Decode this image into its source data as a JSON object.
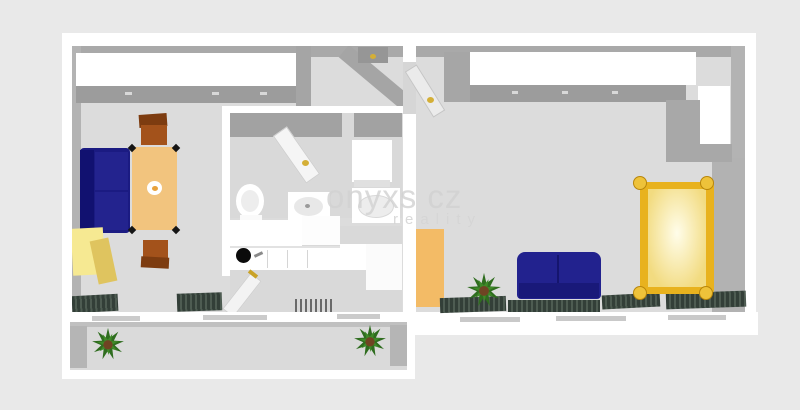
{
  "watermark": {
    "line1": "onyxs cz",
    "line2": "reality"
  },
  "palette": {
    "background": "#e9e9e9",
    "floor": "#dcdcdc",
    "wall_white": "#ffffff",
    "wall_gray": "#a9a9a9",
    "sofa_navy": "#1b1b82",
    "table_tan": "#f2c47e",
    "chair_brown": "#a3521b",
    "cabinet_yellow": "#f6e992",
    "bed_gold": "#e8b21e",
    "wardrobe_orange": "#f3bb66",
    "radiator_green": "#333f38",
    "plant_green": "#2f6d1f",
    "handle_gold": "#d4af37"
  },
  "scene": [
    {
      "name": "floor-left-unit",
      "x": 72,
      "y": 46,
      "w": 331,
      "h": 267,
      "color": "#dcdcdc"
    },
    {
      "name": "floor-bedroom",
      "x": 415,
      "y": 46,
      "w": 330,
      "h": 268,
      "color": "#dcdcdc"
    },
    {
      "name": "top-wall-inner-face",
      "x": 72,
      "y": 46,
      "w": 673,
      "h": 11,
      "color": "#a9a9a9"
    },
    {
      "name": "left-wall-inner-face",
      "x": 72,
      "y": 46,
      "w": 9,
      "h": 267,
      "color": "#b3b3b3"
    },
    {
      "name": "bedroom-right-wall-face-upper",
      "x": 731,
      "y": 46,
      "w": 14,
      "h": 114,
      "color": "#b3b3b3"
    },
    {
      "name": "bedroom-right-wall-face-lower",
      "x": 712,
      "y": 158,
      "w": 33,
      "h": 156,
      "color": "#b2b2b2"
    },
    {
      "name": "livingroom-wardrobe-top",
      "x": 76,
      "y": 53,
      "w": 220,
      "h": 33,
      "color": "#ffffff"
    },
    {
      "name": "livingroom-wardrobe-front",
      "x": 76,
      "y": 86,
      "w": 220,
      "h": 17,
      "color": "#9c9c9c"
    },
    {
      "name": "wardrobe-handle-1",
      "x": 125,
      "y": 92,
      "w": 7,
      "h": 3,
      "color": "#d8d8d8"
    },
    {
      "name": "wardrobe-handle-2",
      "x": 212,
      "y": 92,
      "w": 7,
      "h": 3,
      "color": "#d8d8d8"
    },
    {
      "name": "wardrobe-handle-3",
      "x": 260,
      "y": 92,
      "w": 7,
      "h": 3,
      "color": "#d8d8d8"
    },
    {
      "name": "hall-wall-stub",
      "x": 296,
      "y": 46,
      "w": 15,
      "h": 62,
      "color": "#a5a5a5"
    },
    {
      "name": "hall-diagonal-wall",
      "x": 334,
      "y": 70,
      "w": 84,
      "h": 16,
      "color": "#a5a5a5",
      "rotate": 40
    },
    {
      "name": "hall-entry-door",
      "x": 358,
      "y": 47,
      "w": 30,
      "h": 16,
      "color": "#969696"
    },
    {
      "name": "hall-entry-door-handle",
      "x": 370,
      "y": 54,
      "w": 6,
      "h": 5,
      "color": "#d4af37",
      "radius": "50%"
    },
    {
      "name": "bathroom-wall-left",
      "x": 222,
      "y": 106,
      "w": 8,
      "h": 170,
      "color": "#ffffff"
    },
    {
      "name": "bathroom-wall-top",
      "x": 222,
      "y": 106,
      "w": 186,
      "h": 7,
      "color": "#ffffff"
    },
    {
      "name": "bathroom-floor",
      "x": 230,
      "y": 113,
      "w": 172,
      "h": 105,
      "color": "#d9d9d9"
    },
    {
      "name": "bathroom-top-inner-face-a",
      "x": 230,
      "y": 113,
      "w": 112,
      "h": 24,
      "color": "#a2a2a2"
    },
    {
      "name": "bathroom-top-inner-face-b",
      "x": 354,
      "y": 113,
      "w": 48,
      "h": 24,
      "color": "#a2a2a2"
    },
    {
      "name": "bathroom-door-leaf",
      "x": 288,
      "y": 126,
      "w": 17,
      "h": 58,
      "color": "#f5f5f5",
      "rotate": -35,
      "border": "1px solid #cfcfcf"
    },
    {
      "name": "bathroom-door-handle",
      "x": 302,
      "y": 160,
      "w": 7,
      "h": 6,
      "color": "#d4af37",
      "radius": "50%"
    },
    {
      "name": "washing-machine",
      "x": 352,
      "y": 140,
      "w": 40,
      "h": 42,
      "color": "#ffffff"
    },
    {
      "name": "washing-machine-front",
      "x": 354,
      "y": 180,
      "w": 36,
      "h": 7,
      "color": "#e0e0e0"
    },
    {
      "name": "toilet-bowl",
      "kind": "ellipse",
      "x": 236,
      "y": 184,
      "w": 28,
      "h": 34,
      "color": "#ffffff"
    },
    {
      "name": "toilet-seat",
      "kind": "ellipse",
      "x": 241,
      "y": 190,
      "w": 18,
      "h": 22,
      "color": "#ededed"
    },
    {
      "name": "toilet-base",
      "x": 240,
      "y": 215,
      "w": 22,
      "h": 8,
      "color": "#fafafa"
    },
    {
      "name": "sink-cabinet",
      "x": 288,
      "y": 192,
      "w": 42,
      "h": 30,
      "color": "#ffffff"
    },
    {
      "name": "sink-bowl",
      "kind": "ellipse",
      "x": 294,
      "y": 197,
      "w": 29,
      "h": 19,
      "color": "#e8e8e8"
    },
    {
      "name": "sink-drain",
      "kind": "ellipse",
      "x": 305,
      "y": 204,
      "w": 5,
      "h": 4,
      "color": "#9a9a9a"
    },
    {
      "name": "shower-tray",
      "x": 352,
      "y": 188,
      "w": 48,
      "h": 35,
      "color": "#ffffff"
    },
    {
      "name": "shower-basin",
      "kind": "ellipse",
      "x": 358,
      "y": 195,
      "w": 36,
      "h": 23,
      "color": "#ededed",
      "border": "1px solid #d8d8d8"
    },
    {
      "name": "kitchen-floor",
      "x": 230,
      "y": 226,
      "w": 172,
      "h": 86,
      "color": "#d9d9d9"
    },
    {
      "name": "kitchen-wall-cabinet-a",
      "x": 230,
      "y": 220,
      "w": 72,
      "h": 26,
      "color": "#ffffff"
    },
    {
      "name": "kitchen-wall-cabinet-b",
      "x": 302,
      "y": 216,
      "w": 38,
      "h": 29,
      "color": "#fdfdfd"
    },
    {
      "name": "kitchen-counter",
      "x": 230,
      "y": 246,
      "w": 140,
      "h": 24,
      "color": "#ffffff"
    },
    {
      "name": "kitchen-counter-edge",
      "x": 230,
      "y": 246,
      "w": 140,
      "h": 2,
      "color": "#e2e2e2"
    },
    {
      "name": "kitchen-hob",
      "kind": "ellipse",
      "x": 236,
      "y": 248,
      "w": 15,
      "h": 15,
      "color": "#0b0b0b"
    },
    {
      "name": "kitchen-faucet",
      "x": 254,
      "y": 253,
      "w": 9,
      "h": 3,
      "color": "#8a8a8a",
      "rotate": -25
    },
    {
      "name": "kitchen-cabinet-divider-1",
      "x": 267,
      "y": 250,
      "w": 1,
      "h": 18,
      "color": "#d5d5d5"
    },
    {
      "name": "kitchen-cabinet-divider-2",
      "x": 287,
      "y": 250,
      "w": 1,
      "h": 18,
      "color": "#d5d5d5"
    },
    {
      "name": "kitchen-cabinet-divider-3",
      "x": 307,
      "y": 250,
      "w": 1,
      "h": 18,
      "color": "#d5d5d5"
    },
    {
      "name": "kitchen-counter-right",
      "x": 340,
      "y": 244,
      "w": 62,
      "h": 24,
      "color": "#ffffff"
    },
    {
      "name": "kitchen-fridge",
      "x": 366,
      "y": 244,
      "w": 36,
      "h": 46,
      "color": "#fbfbfb"
    },
    {
      "name": "kitchen-radiator",
      "kind": "stripes",
      "x": 292,
      "y": 299,
      "w": 40,
      "h": 13,
      "color": "#d9d9d9",
      "stripe": "#6a6a6a"
    },
    {
      "name": "kitchen-door-leaf",
      "x": 235,
      "y": 272,
      "w": 14,
      "h": 46,
      "color": "#f3f3f3",
      "rotate": 38,
      "border": "1px solid #d0d0d0"
    },
    {
      "name": "kitchen-door-handle",
      "x": 248,
      "y": 272,
      "w": 10,
      "h": 4,
      "color": "#c9a227",
      "rotate": 38
    },
    {
      "name": "sofa-body",
      "x": 80,
      "y": 148,
      "w": 50,
      "h": 85,
      "color": "#1b1b82",
      "radius": "4px"
    },
    {
      "name": "sofa-backrest",
      "x": 80,
      "y": 150,
      "w": 14,
      "h": 81,
      "color": "#111170"
    },
    {
      "name": "sofa-cushion-top",
      "x": 95,
      "y": 152,
      "w": 33,
      "h": 38,
      "color": "#23238e"
    },
    {
      "name": "sofa-cushion-bottom",
      "x": 95,
      "y": 192,
      "w": 33,
      "h": 38,
      "color": "#23238e"
    },
    {
      "name": "dining-table",
      "x": 132,
      "y": 147,
      "w": 45,
      "h": 83,
      "color": "#f2c47e",
      "radius": "2px"
    },
    {
      "name": "table-foot-top-left",
      "x": 129,
      "y": 145,
      "w": 6,
      "h": 6,
      "color": "#151515",
      "rotate": 45
    },
    {
      "name": "table-foot-top-right",
      "x": 173,
      "y": 145,
      "w": 6,
      "h": 6,
      "color": "#151515",
      "rotate": 45
    },
    {
      "name": "table-foot-bottom-left",
      "x": 129,
      "y": 227,
      "w": 6,
      "h": 6,
      "color": "#151515",
      "rotate": 45
    },
    {
      "name": "table-foot-bottom-right",
      "x": 173,
      "y": 227,
      "w": 6,
      "h": 6,
      "color": "#151515",
      "rotate": 45
    },
    {
      "name": "table-centerpiece",
      "kind": "ellipse",
      "x": 147,
      "y": 181,
      "w": 15,
      "h": 14,
      "color": "#ffffff"
    },
    {
      "name": "table-centerpiece-flower",
      "kind": "ellipse",
      "x": 152,
      "y": 186,
      "w": 6,
      "h": 5,
      "color": "#e8a23c"
    },
    {
      "name": "chair-top-backrest",
      "x": 139,
      "y": 114,
      "w": 28,
      "h": 13,
      "color": "#7d3c10",
      "rotate": -4
    },
    {
      "name": "chair-top-seat",
      "x": 141,
      "y": 125,
      "w": 26,
      "h": 20,
      "color": "#a3521b"
    },
    {
      "name": "chair-bottom-seat",
      "x": 143,
      "y": 240,
      "w": 25,
      "h": 20,
      "color": "#a3521b"
    },
    {
      "name": "chair-bottom-backrest",
      "x": 141,
      "y": 257,
      "w": 28,
      "h": 11,
      "color": "#7d3c10",
      "rotate": 3
    },
    {
      "name": "cabinet-yellow-top",
      "x": 72,
      "y": 228,
      "w": 32,
      "h": 47,
      "color": "#f6e992",
      "rotate": -3
    },
    {
      "name": "cabinet-yellow-front",
      "x": 94,
      "y": 239,
      "w": 19,
      "h": 44,
      "color": "#dfc45f",
      "rotate": -12
    },
    {
      "name": "livingroom-radiator-left",
      "kind": "stripes",
      "x": 72,
      "y": 295,
      "w": 46,
      "h": 17,
      "color": "#333f38",
      "stripe": "#4e5c52",
      "rotate": -3
    },
    {
      "name": "livingroom-radiator-mid",
      "kind": "stripes",
      "x": 177,
      "y": 293,
      "w": 45,
      "h": 18,
      "color": "#333f38",
      "stripe": "#4e5c52",
      "rotate": -2
    },
    {
      "name": "divider-door-opening-floor",
      "x": 403,
      "y": 60,
      "w": 13,
      "h": 56,
      "color": "#d6d6d6"
    },
    {
      "name": "outer-wall-top",
      "x": 62,
      "y": 33,
      "w": 694,
      "h": 13,
      "color": "#ffffff"
    },
    {
      "name": "outer-wall-left",
      "x": 62,
      "y": 33,
      "w": 10,
      "h": 290,
      "color": "#ffffff"
    },
    {
      "name": "unit-divider-wall-upper",
      "x": 403,
      "y": 33,
      "w": 13,
      "h": 29,
      "color": "#ffffff"
    },
    {
      "name": "unit-divider-wall-lower",
      "x": 403,
      "y": 114,
      "w": 13,
      "h": 199,
      "color": "#ffffff"
    },
    {
      "name": "outer-wall-right",
      "x": 745,
      "y": 33,
      "w": 11,
      "h": 300,
      "color": "#ffffff"
    },
    {
      "name": "window-sill-left-unit",
      "x": 62,
      "y": 312,
      "w": 353,
      "h": 11,
      "color": "#ffffff"
    },
    {
      "name": "window-sill-bedroom",
      "x": 404,
      "y": 312,
      "w": 354,
      "h": 23,
      "color": "#ffffff"
    },
    {
      "name": "window-frame-left-1",
      "x": 92,
      "y": 316,
      "w": 48,
      "h": 5,
      "color": "#cbcbcb"
    },
    {
      "name": "window-frame-left-2",
      "x": 203,
      "y": 315,
      "w": 64,
      "h": 5,
      "color": "#cbcbcb"
    },
    {
      "name": "window-frame-left-3",
      "x": 337,
      "y": 314,
      "w": 43,
      "h": 5,
      "color": "#cbcbcb"
    },
    {
      "name": "window-frame-right-1",
      "x": 460,
      "y": 317,
      "w": 60,
      "h": 5,
      "color": "#c9c9c9"
    },
    {
      "name": "window-frame-right-2",
      "x": 556,
      "y": 316,
      "w": 70,
      "h": 5,
      "color": "#c9c9c9"
    },
    {
      "name": "window-frame-right-3",
      "x": 668,
      "y": 315,
      "w": 58,
      "h": 5,
      "color": "#c9c9c9"
    },
    {
      "name": "bedroom-entry-door-leaf",
      "x": 418,
      "y": 64,
      "w": 14,
      "h": 54,
      "color": "#ebebeb",
      "rotate": -32,
      "border": "1px solid #c5c5c5"
    },
    {
      "name": "bedroom-entry-door-handle",
      "x": 427,
      "y": 97,
      "w": 7,
      "h": 6,
      "color": "#d4af37",
      "radius": "50%"
    },
    {
      "name": "bedroom-wardrobe-side",
      "x": 444,
      "y": 52,
      "w": 26,
      "h": 50,
      "color": "#a6a6a6"
    },
    {
      "name": "bedroom-wardrobe-top",
      "x": 470,
      "y": 52,
      "w": 226,
      "h": 33,
      "color": "#ffffff"
    },
    {
      "name": "bedroom-wardrobe-front",
      "x": 470,
      "y": 85,
      "w": 216,
      "h": 17,
      "color": "#9c9c9c"
    },
    {
      "name": "bedroom-wardrobe-handle-1",
      "x": 512,
      "y": 91,
      "w": 6,
      "h": 3,
      "color": "#d8d8d8"
    },
    {
      "name": "bedroom-wardrobe-handle-2",
      "x": 562,
      "y": 91,
      "w": 6,
      "h": 3,
      "color": "#d8d8d8"
    },
    {
      "name": "bedroom-wardrobe-handle-3",
      "x": 612,
      "y": 91,
      "w": 6,
      "h": 3,
      "color": "#d8d8d8"
    },
    {
      "name": "bedroom-side-cabinet",
      "x": 698,
      "y": 86,
      "w": 32,
      "h": 58,
      "color": "#ffffff"
    },
    {
      "name": "bedroom-wall-column",
      "x": 666,
      "y": 100,
      "w": 34,
      "h": 62,
      "color": "#a8a8a8"
    },
    {
      "name": "bedroom-wall-under-cabinet",
      "x": 698,
      "y": 144,
      "w": 34,
      "h": 18,
      "color": "#a8a8a8"
    },
    {
      "name": "bedroom-wardrobe-orange",
      "x": 416,
      "y": 229,
      "w": 28,
      "h": 78,
      "color": "#f3bb66"
    },
    {
      "name": "bedroom-radiator-1",
      "kind": "stripes",
      "x": 440,
      "y": 297,
      "w": 66,
      "h": 15,
      "color": "#333f38",
      "stripe": "#4e5c52",
      "rotate": -2
    },
    {
      "name": "bedroom-sofa-body",
      "x": 517,
      "y": 252,
      "w": 84,
      "h": 47,
      "color": "#22228e",
      "radius": "8px 8px 4px 4px"
    },
    {
      "name": "bedroom-sofa-divider",
      "x": 557,
      "y": 255,
      "w": 2,
      "h": 32,
      "color": "#15156e"
    },
    {
      "name": "bedroom-sofa-base",
      "x": 519,
      "y": 283,
      "w": 80,
      "h": 15,
      "color": "#191979"
    },
    {
      "name": "bedroom-radiator-2",
      "kind": "stripes",
      "x": 508,
      "y": 300,
      "w": 92,
      "h": 12,
      "color": "#333f38",
      "stripe": "#4e5c52"
    },
    {
      "name": "bedroom-radiator-3",
      "kind": "stripes",
      "x": 602,
      "y": 294,
      "w": 58,
      "h": 14,
      "color": "#333f38",
      "stripe": "#4e5c52",
      "rotate": -3
    },
    {
      "name": "bedroom-plant",
      "kind": "plant",
      "x": 466,
      "y": 272,
      "w": 36,
      "h": 36,
      "leaf": "#2f6d1f",
      "leaf2": "#3f8a28",
      "pot": "#6f4423"
    },
    {
      "name": "bed-radiator",
      "kind": "stripes",
      "x": 666,
      "y": 292,
      "w": 80,
      "h": 16,
      "color": "#333f38",
      "stripe": "#4e5c52",
      "rotate": -2
    },
    {
      "name": "bed-frame",
      "x": 640,
      "y": 182,
      "w": 74,
      "h": 112,
      "color": "#e8b21e",
      "radius": "4px"
    },
    {
      "name": "bed-mattress",
      "kind": "glow",
      "x": 648,
      "y": 189,
      "w": 58,
      "h": 98,
      "color": "#f2db80",
      "glow": "#fffdea"
    },
    {
      "name": "bed-post-top-left",
      "kind": "ellipse",
      "x": 633,
      "y": 176,
      "w": 14,
      "h": 14,
      "color": "#eec23a",
      "border": "1px solid #b8860b"
    },
    {
      "name": "bed-post-top-right",
      "kind": "ellipse",
      "x": 700,
      "y": 176,
      "w": 14,
      "h": 14,
      "color": "#eec23a",
      "border": "1px solid #b8860b"
    },
    {
      "name": "bed-post-bottom-left",
      "kind": "ellipse",
      "x": 633,
      "y": 286,
      "w": 14,
      "h": 14,
      "color": "#eec23a",
      "border": "1px solid #b8860b"
    },
    {
      "name": "bed-post-bottom-right",
      "kind": "ellipse",
      "x": 699,
      "y": 286,
      "w": 14,
      "h": 14,
      "color": "#eec23a",
      "border": "1px solid #b8860b"
    },
    {
      "name": "balcony-floor",
      "x": 70,
      "y": 322,
      "w": 337,
      "h": 48,
      "color": "#dadada"
    },
    {
      "name": "balcony-top-shadow",
      "x": 70,
      "y": 322,
      "w": 337,
      "h": 5,
      "color": "#c0c0c0"
    },
    {
      "name": "balcony-left-inner-wall",
      "x": 70,
      "y": 326,
      "w": 17,
      "h": 42,
      "color": "#b5b5b5"
    },
    {
      "name": "balcony-right-inner-wall",
      "x": 390,
      "y": 325,
      "w": 17,
      "h": 41,
      "color": "#b5b5b5"
    },
    {
      "name": "balcony-outer-wall-left",
      "x": 62,
      "y": 322,
      "w": 8,
      "h": 56,
      "color": "#ffffff"
    },
    {
      "name": "balcony-outer-wall-bottom",
      "x": 62,
      "y": 370,
      "w": 353,
      "h": 9,
      "color": "#ffffff"
    },
    {
      "name": "balcony-outer-wall-right",
      "x": 407,
      "y": 322,
      "w": 8,
      "h": 56,
      "color": "#ffffff"
    },
    {
      "name": "balcony-plant-left",
      "kind": "plant",
      "x": 91,
      "y": 327,
      "w": 34,
      "h": 34,
      "leaf": "#2f6d1f",
      "leaf2": "#3f8a28",
      "pot": "#6f4423"
    },
    {
      "name": "balcony-plant-right",
      "kind": "plant",
      "x": 353,
      "y": 324,
      "w": 34,
      "h": 34,
      "leaf": "#2f6d1f",
      "leaf2": "#3f8a28",
      "pot": "#6f4423"
    }
  ]
}
